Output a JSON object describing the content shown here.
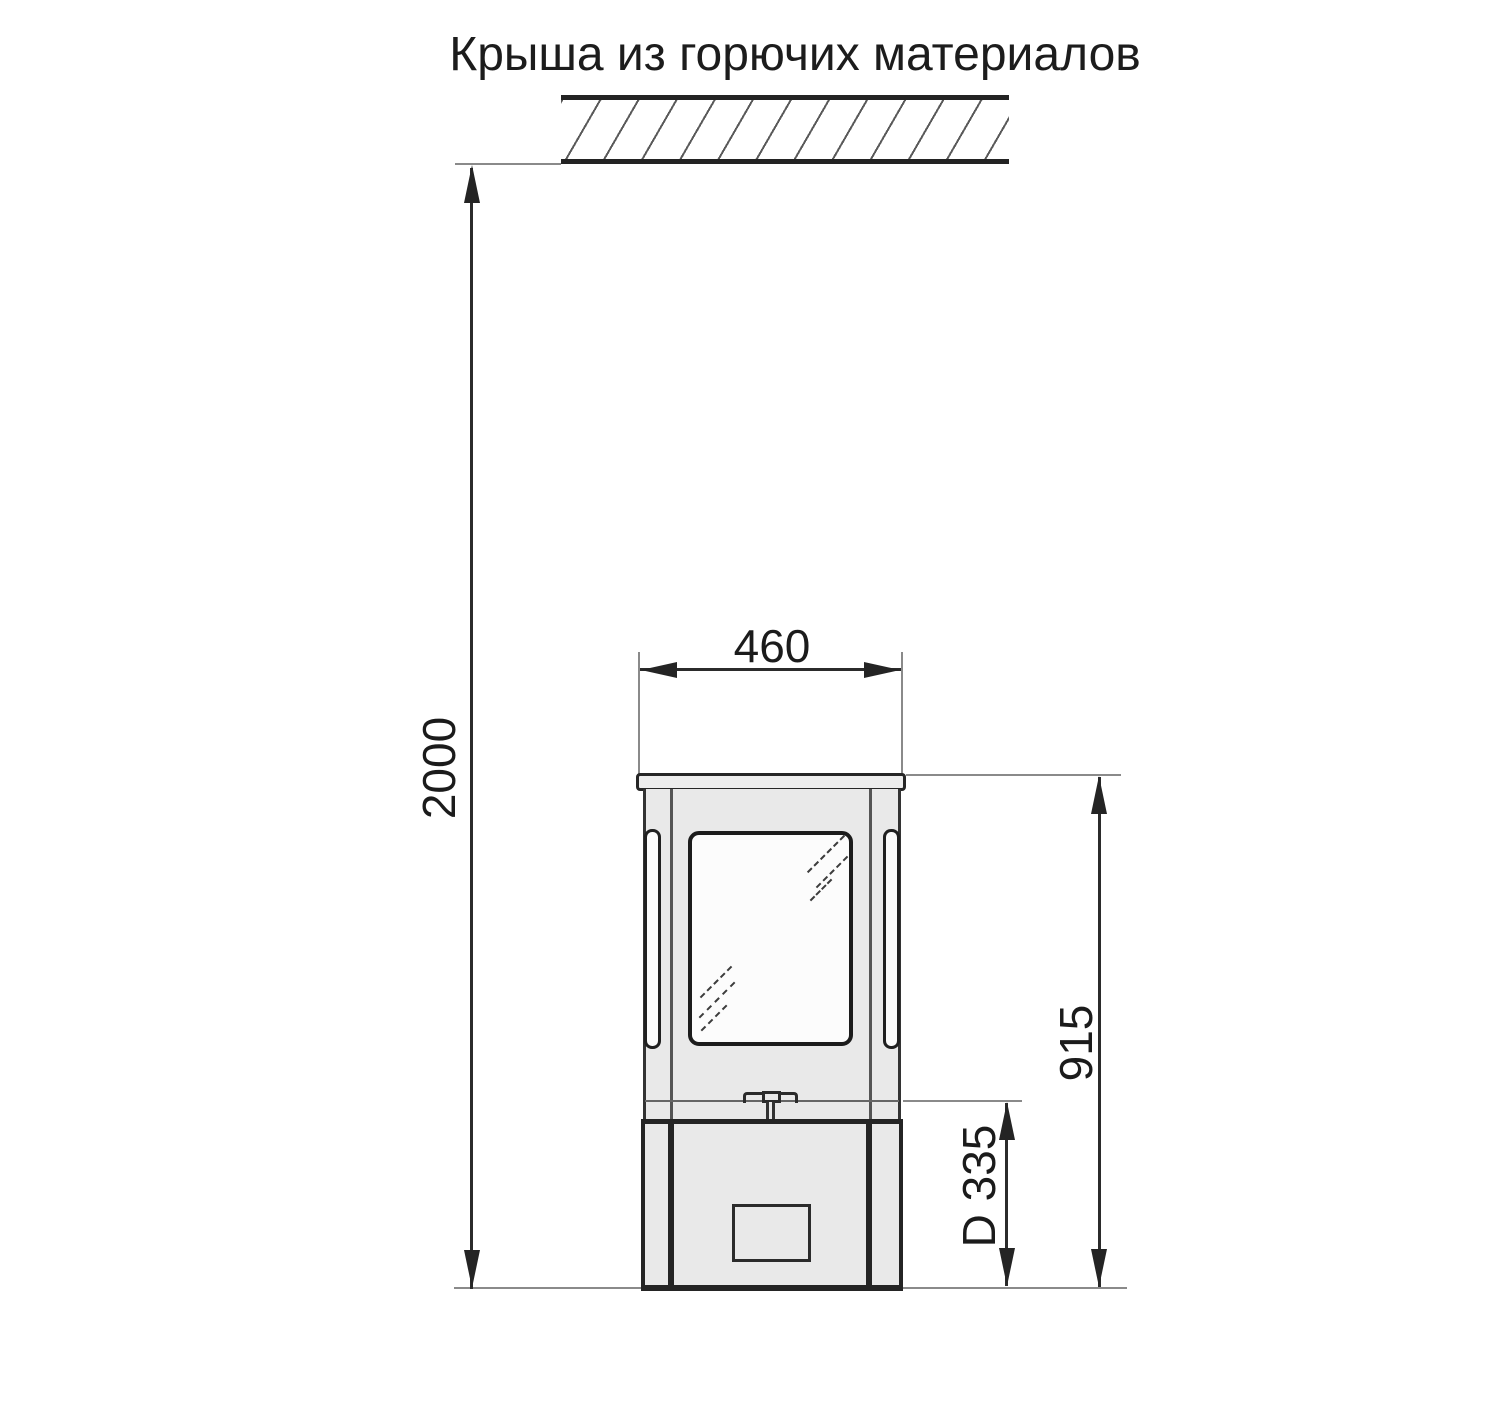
{
  "title": "Крыша из горючих материалов",
  "dimensions": {
    "roof_clearance": "2000",
    "stove_width": "460",
    "stove_height": "915",
    "flue_outlet": "D 335"
  },
  "colors": {
    "outline": "#2b2b2b",
    "extension_line": "#8a8a8a",
    "hatch_line": "#5a5a5a",
    "stove_body_fill": "#e9e9e9",
    "glass_fill": "#fcfcfc",
    "text": "#1b1b1b",
    "background": "#ffffff"
  }
}
